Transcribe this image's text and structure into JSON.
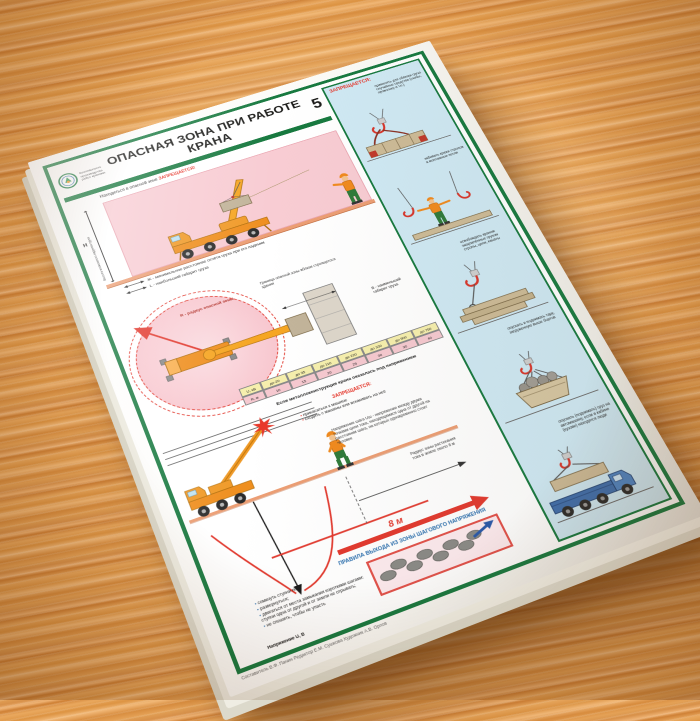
{
  "colors": {
    "frame_green": "#17793f",
    "danger_pink": "#f8ccd3",
    "alert_red": "#e63226",
    "column_blue": "#cfe9f4",
    "crane_orange": "#f09a28",
    "wood": "#dd9848",
    "table_yellow": "#f6efad",
    "table_pink": "#f6c9d0"
  },
  "poster": {
    "number": "5",
    "title": "ОПАСНАЯ ЗОНА ПРИ РАБОТЕ КРАНА",
    "logo_lines": "Безопасность\nпроизводства\nработ кранами",
    "side_view": {
      "caption_text": "Находиться в опасной зоне",
      "caption_forbidden": "ЗАПРЕЩАЕТСЯ!",
      "height_symbol": "Н",
      "height_label": "Высота возможного падения груза",
      "legend_zh": "Ж - минимальное расстояние отлёта груза при его падении",
      "legend_l": "L - наибольший габарит груза"
    },
    "plan_view": {
      "radius_label": "R - радиус опасной зоны",
      "boundary_label": "Граница опасной зоны вблизи строящегося здания",
      "legend_b": "В - наименьший габарит груза",
      "table": {
        "row1_label": "U, кВ",
        "row2_label": "R, м",
        "columns": [
          "до 20",
          "до 35",
          "до 110",
          "до 220",
          "до 330",
          "до 500",
          "до 750"
        ],
        "values": [
          "10",
          "15",
          "20",
          "25",
          "30",
          "30",
          "40"
        ]
      }
    },
    "step_voltage": {
      "intro": "Если металлоконструкция крана оказалась под напряжением",
      "forbidden_title": "ЗАПРЕЩАЕТСЯ:",
      "forbidden_items": [
        "прикасаться к машине",
        "сходить с машины или вскакивать на неё"
      ],
      "definition": "Напряжение шага Uш - напряжение между двумя точками цепи тока, находящимися одна от другой на расстоянии шага, на которых одновременно стоит человек",
      "note": "Радиус зоны растекания тока в земле около 8 м",
      "distance_label": "8 м",
      "rules_title": "ПРАВИЛА ВЫХОДА ИЗ ЗОНЫ ШАГОВОГО НАПРЯЖЕНИЯ",
      "exit_rules": [
        "сомкнуть ступни ног;",
        "развернуться;",
        "двигаться от места замыкания короткими шагами: ступни одна от другой и от земли не отрывать;",
        "не спешить, чтобы не упасть"
      ],
      "axis_label": "Напряжение U, В"
    },
    "prohibited_column": {
      "header": "ЗАПРЕЩАЕТСЯ:",
      "items": [
        "применять для обвязки груза случайные средства (скобы, проволоку и т.п.)",
        "забивать крюки стропов в монтажные петли",
        "освобождать краном защемлённые грузом стропы, цепи, канаты",
        "опускать и поднимать тару, загруженную выше бортов",
        "опускать (поднимать) груз на автомашину, если в кабине (кузове) находятся люди"
      ]
    },
    "credits": "Составитель В.Ф. Панин    Редактор Е.М. Сушкова    Художник А.В. Орлов"
  }
}
